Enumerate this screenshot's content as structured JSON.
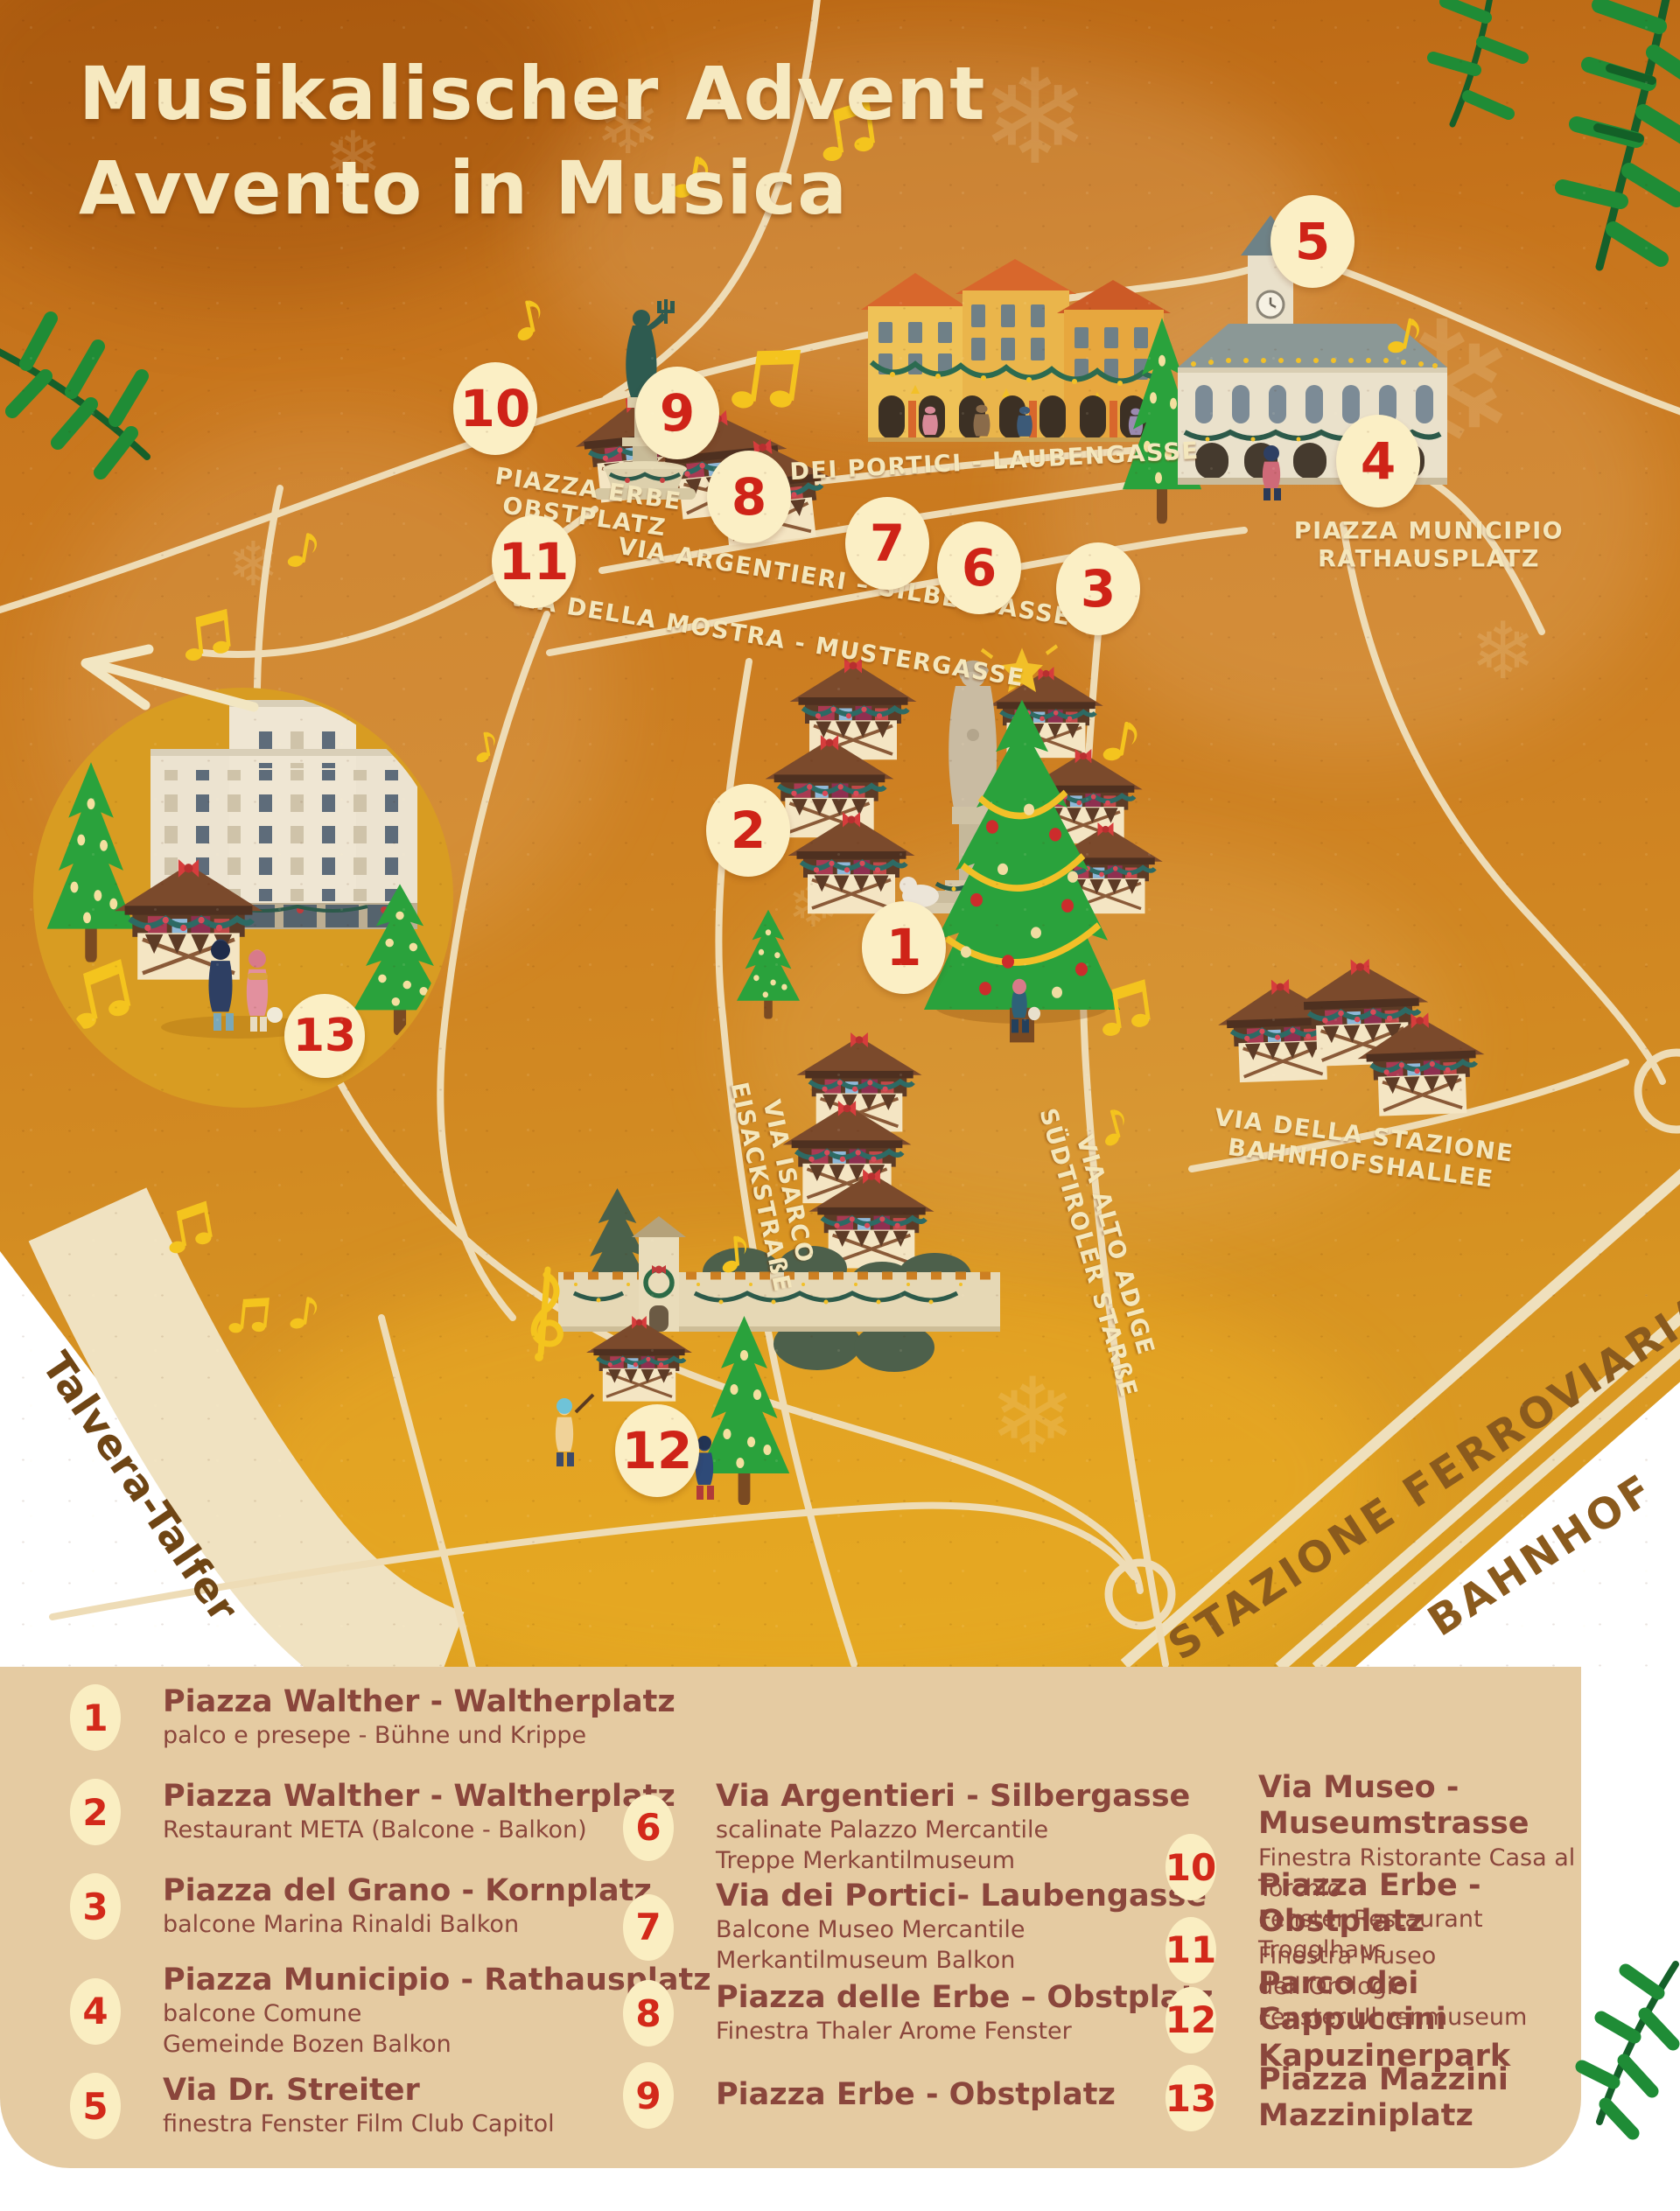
{
  "title": {
    "line1": "Musikalischer Advent",
    "line2": "Avvento in Musica"
  },
  "map": {
    "markers": {
      "m1": "1",
      "m2": "2",
      "m3": "3",
      "m4": "4",
      "m5": "5",
      "m6": "6",
      "m7": "7",
      "m8": "8",
      "m9": "9",
      "m10": "10",
      "m11": "11",
      "m12": "12",
      "m13": "13"
    },
    "streets": {
      "piazza_erbe_1": "PIAZZA ERBE",
      "piazza_erbe_2": "OBSTPLATZ",
      "portici": "VIA DEI PORTICI - LAUBENGASSE",
      "argentieri": "VIA ARGENTIERI – SILBERGASSE",
      "mostra": "VIA DELLA MOSTRA - MUSTERGASSE",
      "municipio_1": "PIAZZA MUNICIPIO",
      "municipio_2": "RATHAUSPLATZ",
      "stazione_1": "VIA DELLA STAZIONE",
      "stazione_2": "BAHNHOFSHALLEE",
      "isarco_1": "VIA ISARCO",
      "isarco_2": "EISACKSTRAßE",
      "alto_adige_1": "VIA ALTO ADIGE",
      "alto_adige_2": "SÜDTIROLER STARßE",
      "talvera": "Talvera-Talfer",
      "ferroviaria": "STAZIONE FERROVIARIA",
      "bahnhof": "BAHNHOF"
    }
  },
  "legend": {
    "items": [
      {
        "n": "1",
        "title": "Piazza Walther - Waltherplatz",
        "desc1": "palco e presepe - Bühne und Krippe"
      },
      {
        "n": "2",
        "title": "Piazza Walther - Waltherplatz",
        "desc1": "Restaurant META (Balcone - Balkon)"
      },
      {
        "n": "3",
        "title": "Piazza del Grano - Kornplatz",
        "desc1": "balcone Marina Rinaldi Balkon"
      },
      {
        "n": "4",
        "title": "Piazza Municipio - Rathausplatz",
        "desc1": "balcone Comune",
        "desc2": "Gemeinde Bozen Balkon"
      },
      {
        "n": "5",
        "title": "Via Dr. Streiter",
        "desc1": "finestra Fenster Film Club Capitol"
      },
      {
        "n": "6",
        "title": "Via Argentieri - Silbergasse",
        "desc1": "scalinate Palazzo Mercantile",
        "desc2": "Treppe Merkantilmuseum"
      },
      {
        "n": "7",
        "title": "Via dei Portici- Laubengasse",
        "desc1": "Balcone Museo Mercantile",
        "desc2": "Merkantilmuseum Balkon"
      },
      {
        "n": "8",
        "title": "Piazza delle Erbe – Obstplatz",
        "desc1": "Finestra Thaler Arome Fenster"
      },
      {
        "n": "9",
        "title": "Piazza Erbe - Obstplatz"
      },
      {
        "n": "10",
        "title": "Via Museo - Museumstrasse",
        "desc1": "Finestra Ristorante Casa al Torchio",
        "desc2": "Fenster Restaurant Trogglhaus"
      },
      {
        "n": "11",
        "title": "Piazza Erbe - Obstplatz",
        "desc1": "Finestra Museo dell’Orologio",
        "desc2": "Fenster Uhrenmuseum"
      },
      {
        "n": "12",
        "title": "Parco dei Cappuccini",
        "title2": "Kapuzinerpark"
      },
      {
        "n": "13",
        "title": "Piazza Mazzini",
        "title2": "Mazziniplatz"
      }
    ]
  },
  "colors": {
    "map_orange": "#c8761d",
    "legend_bg": "#e5cba2",
    "badge_cream": "#fbefc5",
    "badge_red": "#cf2318",
    "label_cream": "#f4e7bd",
    "text_maroon": "#8a463c",
    "road_beige": "#eedcb6",
    "gold_note": "#f4c41e",
    "tree_green": "#2aa23c",
    "roof_brown": "#7b4a2c"
  }
}
